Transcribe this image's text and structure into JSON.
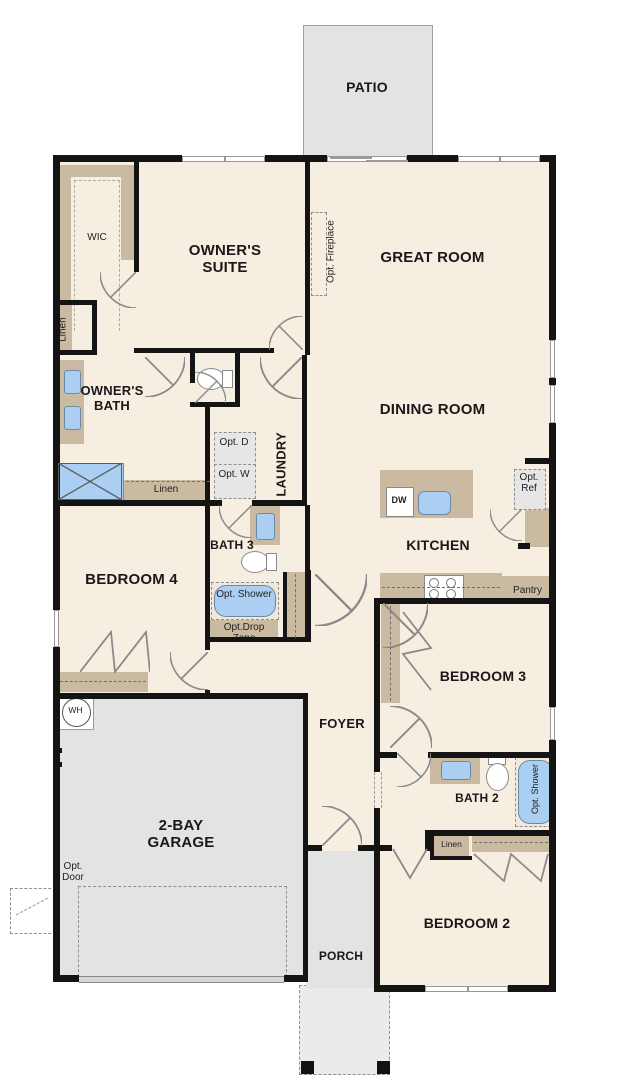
{
  "title": "Single-story floor plan",
  "rooms": {
    "patio": "PATIO",
    "owners_suite": "OWNER'S SUITE",
    "great_room": "GREAT ROOM",
    "wic": "WIC",
    "owners_bath": "OWNER'S BATH",
    "dining_room": "DINING ROOM",
    "kitchen": "KITCHEN",
    "laundry": "LAUNDRY",
    "bath_3": "BATH 3",
    "bedroom_4": "BEDROOM 4",
    "garage": "2-BAY GARAGE",
    "foyer": "FOYER",
    "bedroom_3": "BEDROOM 3",
    "bath_2": "BATH 2",
    "bedroom_2": "BEDROOM 2",
    "porch": "PORCH",
    "pantry": "Pantry"
  },
  "closets": {
    "linen_hall": "Linen",
    "linen_bath": "Linen",
    "linen_bath2": "Linen"
  },
  "optional": {
    "fireplace": "Opt. Fireplace",
    "dryer": "Opt. D",
    "washer": "Opt. W",
    "ref": "Opt. Ref",
    "shower_bath3": "Opt. Shower",
    "shower_bath2": "Opt. Shower",
    "drop_zone": "Opt.Drop Zone",
    "door": "Opt. Door"
  },
  "fixtures": {
    "dishwasher": "DW",
    "water_heater": "WH"
  },
  "colors": {
    "floor": "#f6eee1",
    "wall": "#141414",
    "cabinet_tan": "#c9baa1",
    "slab_gray": "#e3e3e2",
    "fixture_blue": "#abcff2"
  }
}
